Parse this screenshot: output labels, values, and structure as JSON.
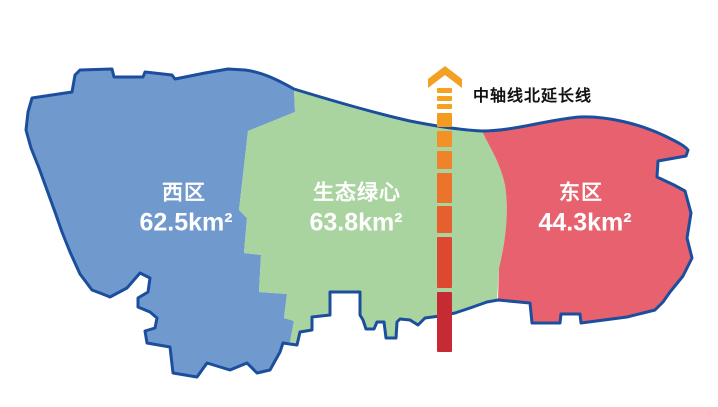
{
  "map": {
    "outline_color": "#1C4E9E",
    "background_color": "#FFFFFF",
    "regions": [
      {
        "id": "west",
        "name": "西区",
        "area": "62.5km²",
        "color": "#7099CD"
      },
      {
        "id": "green-heart",
        "name": "生态绿心",
        "area": "63.8km²",
        "color": "#A9D4A0"
      },
      {
        "id": "east",
        "name": "东区",
        "area": "44.3km²",
        "color": "#E7616E"
      }
    ]
  },
  "axis": {
    "label": "中轴线北延长线",
    "arrow_color": "#F2A124",
    "x": 437,
    "width": 15,
    "dashes": [
      {
        "y": 88,
        "h": 5,
        "color": "#F5A21F"
      },
      {
        "y": 96,
        "h": 5,
        "color": "#F5A21F"
      },
      {
        "y": 104,
        "h": 5,
        "color": "#F5A021"
      },
      {
        "y": 113,
        "h": 14,
        "color": "#F49C22"
      },
      {
        "y": 131,
        "h": 16,
        "color": "#F29126"
      },
      {
        "y": 151,
        "h": 18,
        "color": "#EF8329"
      },
      {
        "y": 173,
        "h": 30,
        "color": "#EC732C"
      },
      {
        "y": 206,
        "h": 27,
        "color": "#E65F2F"
      },
      {
        "y": 237,
        "h": 51,
        "color": "#DE4831"
      },
      {
        "y": 292,
        "h": 60,
        "color": "#C62A33"
      }
    ]
  }
}
